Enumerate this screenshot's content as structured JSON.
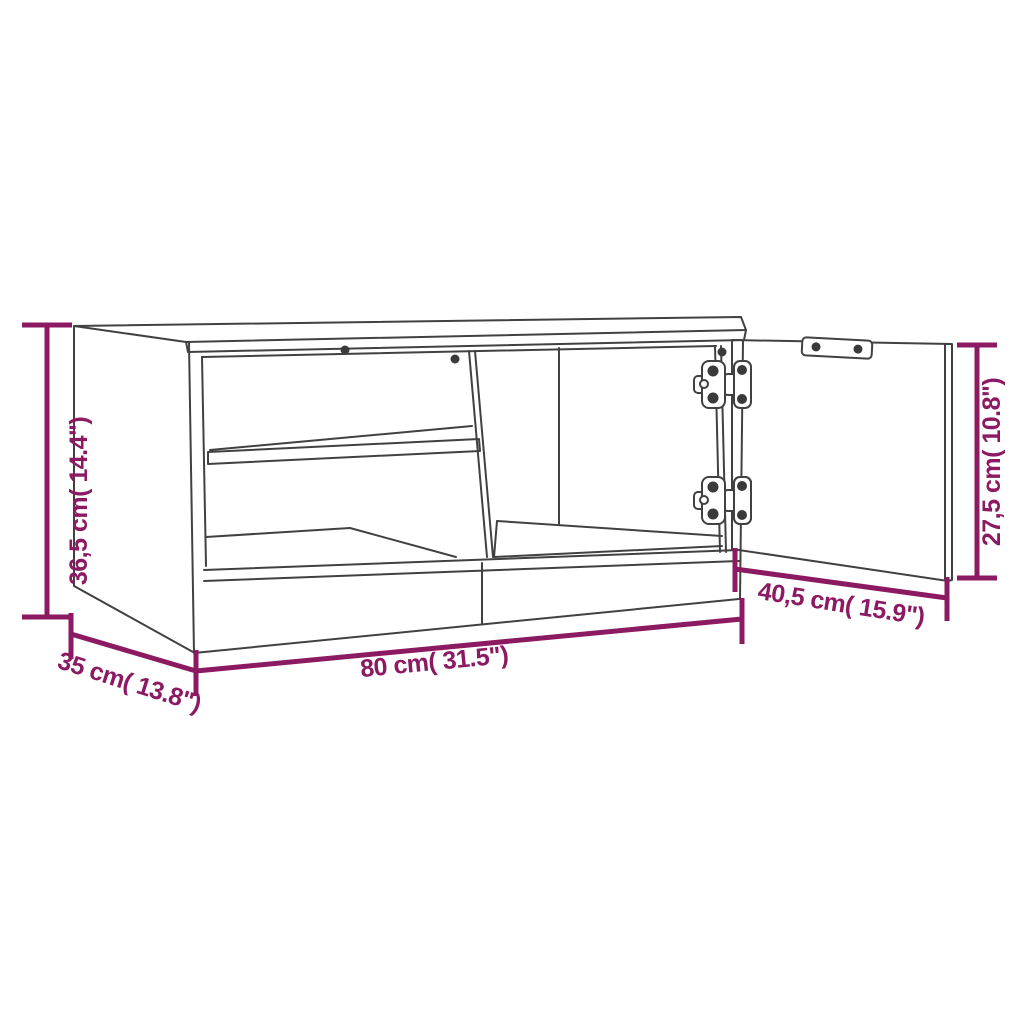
{
  "diagram": {
    "type": "furniture-dimension-diagram",
    "subject": "TV cabinet line drawing with open door, shelf compartments and euro hinges",
    "background": "#ffffff",
    "line_color": "#414141",
    "dimension_color": "#8c1a62",
    "dimensions": {
      "height": {
        "label": "36,5 cm( 14.4\")",
        "value_cm": "36,5",
        "value_in": "14.4",
        "orientation": "vertical-left"
      },
      "width": {
        "label": "80 cm( 31.5\")",
        "value_cm": "80",
        "value_in": "31.5",
        "orientation": "horizontal-bottom"
      },
      "depth": {
        "label": "35 cm( 13.8\")",
        "value_cm": "35",
        "value_in": "13.8",
        "orientation": "diagonal-bottom-left"
      },
      "door_width": {
        "label": "40,5 cm( 15.9\")",
        "value_cm": "40,5",
        "value_in": "15.9",
        "orientation": "diagonal-bottom-right"
      },
      "door_height": {
        "label": "27,5 cm( 10.8\")",
        "value_cm": "27,5",
        "value_in": "10.8",
        "orientation": "vertical-right"
      }
    }
  }
}
